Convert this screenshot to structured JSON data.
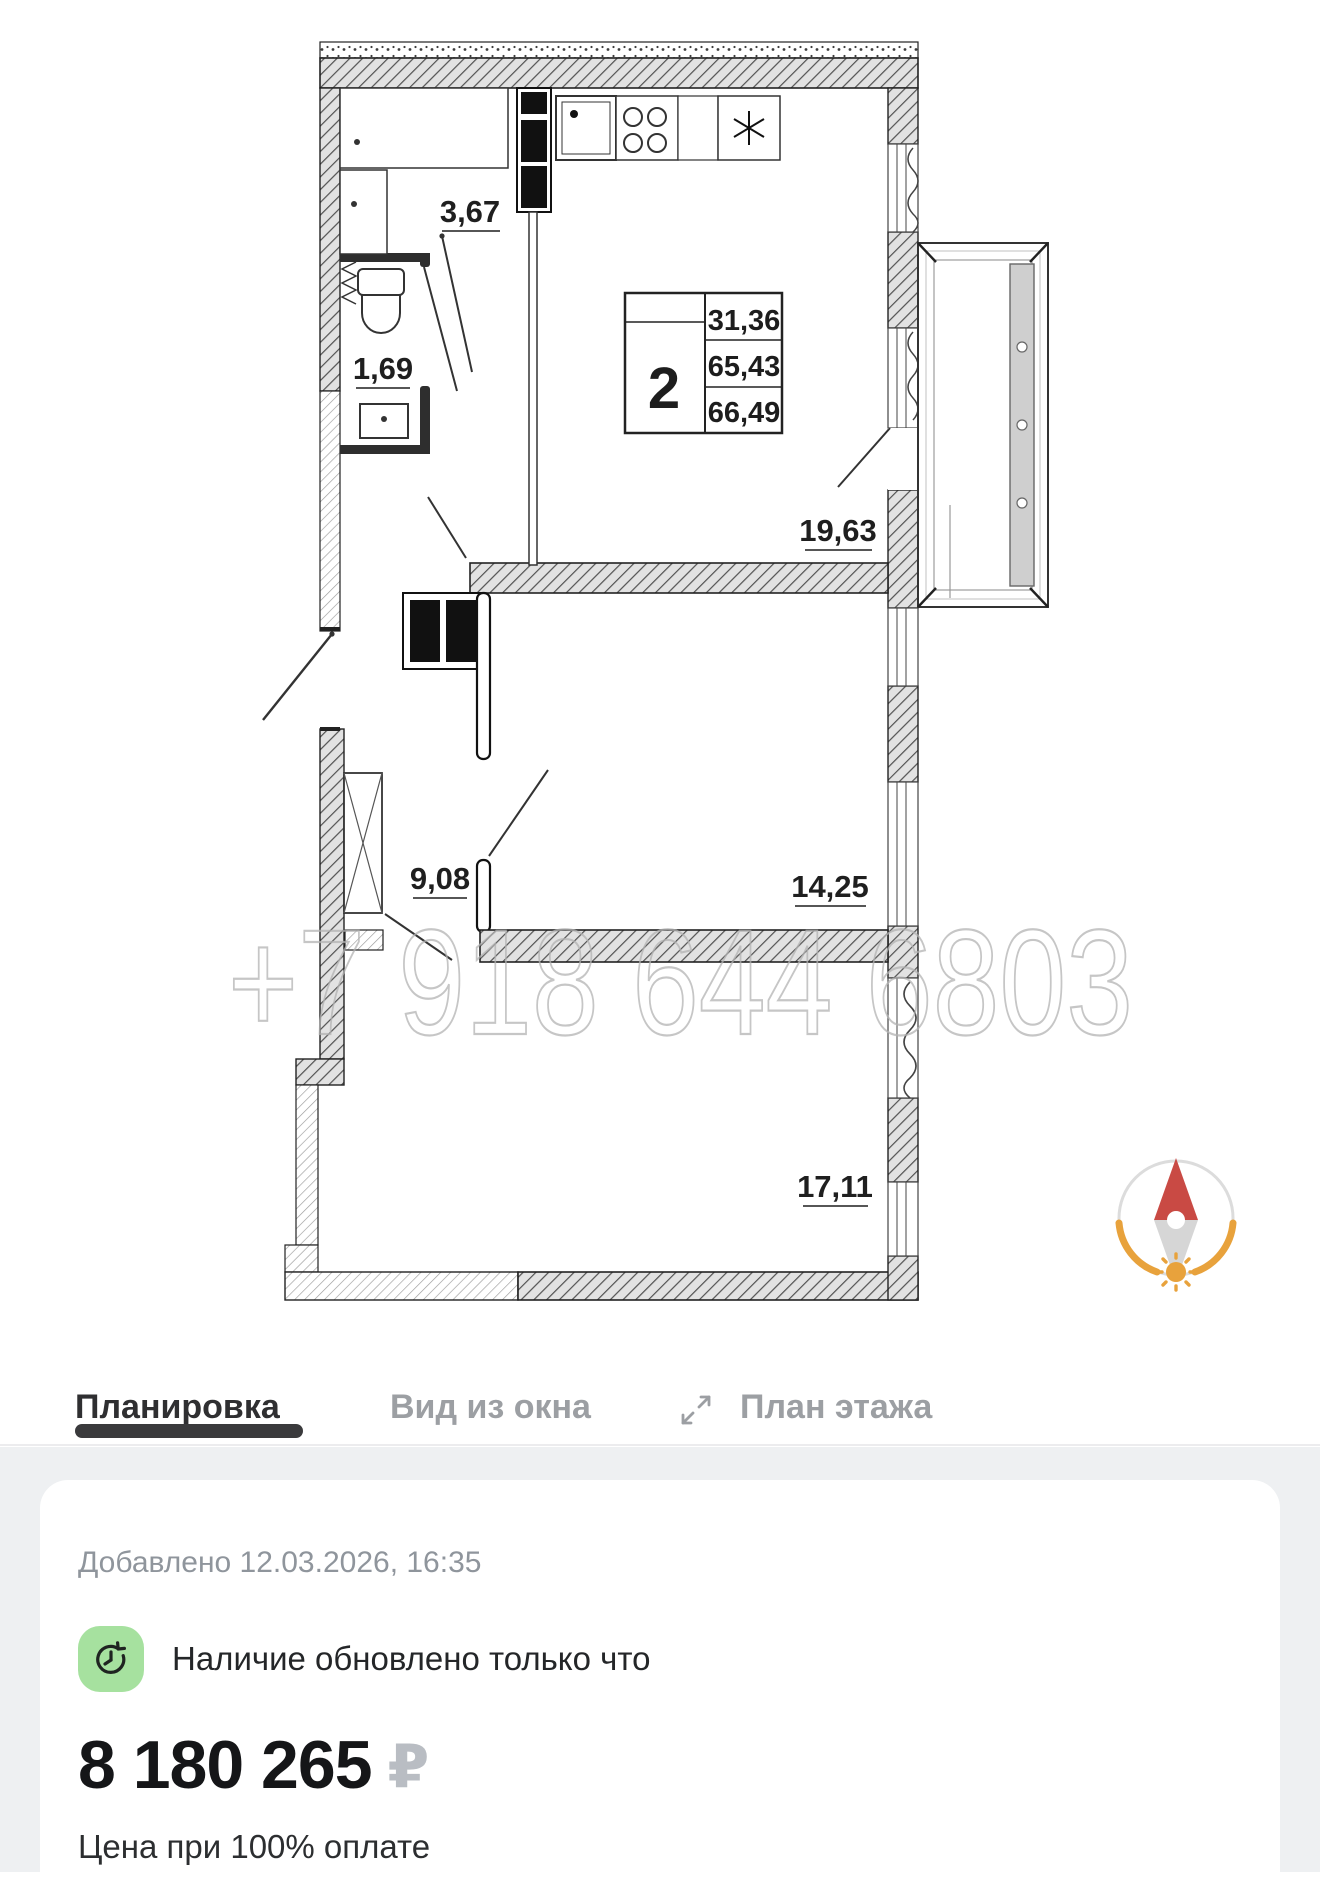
{
  "floorplan": {
    "watermark": "+7 918 644 6803",
    "info_table": {
      "rooms": "2",
      "values": [
        "31,36",
        "65,43",
        "66,49"
      ]
    },
    "room_labels": [
      {
        "name": "hallway-top",
        "text": "3,67"
      },
      {
        "name": "bathroom",
        "text": "1,69"
      },
      {
        "name": "living-room",
        "text": "19,63"
      },
      {
        "name": "hallway",
        "text": "9,08"
      },
      {
        "name": "bedroom",
        "text": "14,25"
      },
      {
        "name": "room-bottom",
        "text": "17,11"
      }
    ]
  },
  "tabs": [
    {
      "label": "Планировка",
      "active": true
    },
    {
      "label": "Вид из окна",
      "active": false
    },
    {
      "label": "План этажа",
      "active": false,
      "icon": "expand-icon"
    }
  ],
  "details": {
    "added": "Добавлено 12.03.2026, 16:35",
    "availability": "Наличие обновлено только что",
    "price": "8 180 265",
    "currency": "₽",
    "price_note": "Цена при 100% оплате"
  },
  "colors": {
    "availability_icon_bg": "#a6e19f",
    "compass_orange": "#e8a23c",
    "compass_needle_red": "#c94a44",
    "tab_active": "#2f2f31",
    "tab_inactive": "#9c9fa3",
    "watermark_gray": "#b3b3b3"
  }
}
